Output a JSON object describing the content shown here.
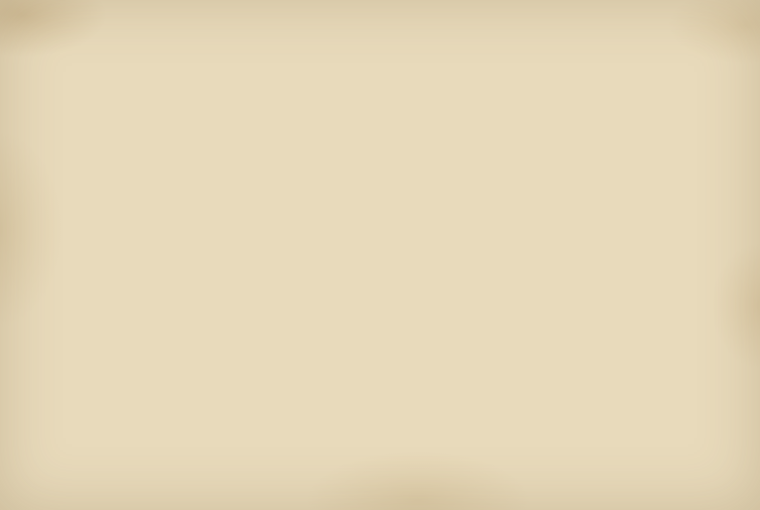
{
  "map": {
    "compass": {
      "south": "南",
      "north": "北",
      "west": "西"
    },
    "palette": {
      "paper": "#e8dabb",
      "paper_light": "#efe3c6",
      "water": "#adc2cc",
      "water_deep": "#93abba",
      "water_light": "#c9d6db",
      "bank_dark": "#3f3426",
      "bank_mid": "#8a7457",
      "bank_block": "#55462f",
      "ink": "#433827",
      "ink_dark": "#171310",
      "red": "#bf3a28",
      "salmon": "#df9166",
      "g1": "#b5c08c",
      "g2": "#a9b77e",
      "p1": "#f0d9cf",
      "p2": "#ecd3c6",
      "cream": "#f0e5c6",
      "blue": "#7495b4",
      "red_bldg": "#b5532f",
      "yellow": "#e6c93f",
      "slip": "#faf4e3",
      "stamp": "#6b6b3a"
    },
    "parcels": [
      {
        "x": 0,
        "y": 178,
        "w": 22,
        "h": 46,
        "r": -10,
        "f": "p1",
        "t": "嶋屋"
      },
      {
        "x": 36,
        "y": 160,
        "w": 30,
        "h": 62,
        "r": -10,
        "f": "p1",
        "t": "樽屋"
      },
      {
        "x": 70,
        "y": 150,
        "w": 26,
        "h": 50,
        "r": -10,
        "f": "cream",
        "t": ""
      },
      {
        "x": 146,
        "y": 128,
        "w": 34,
        "h": 88,
        "r": -8,
        "f": "p1",
        "t": "美濃屋"
      },
      {
        "x": 183,
        "y": 144,
        "w": 26,
        "h": 54,
        "r": -8,
        "f": "p2",
        "t": "蔵"
      },
      {
        "x": 152,
        "y": 194,
        "w": 62,
        "h": 20,
        "r": -8,
        "f": "g1",
        "t": "平野屋",
        "hz": 1,
        "fs": 5
      },
      {
        "x": 177,
        "y": 122,
        "w": 16,
        "h": 13,
        "r": -8,
        "f": "g2",
        "t": ""
      },
      {
        "x": 262,
        "y": 124,
        "w": 30,
        "h": 72,
        "r": -5,
        "f": "p1",
        "t": "蔵"
      },
      {
        "x": 295,
        "y": 118,
        "w": 24,
        "h": 58,
        "r": -5,
        "f": "cream",
        "t": ""
      },
      {
        "x": 210,
        "y": 94,
        "w": 38,
        "h": 40,
        "r": -4,
        "f": "g1",
        "t": "町会所",
        "fs": 6
      },
      {
        "x": 250,
        "y": 100,
        "w": 44,
        "h": 38,
        "r": -4,
        "f": "cream",
        "t": ""
      },
      {
        "x": 322,
        "y": 96,
        "w": 40,
        "h": 40,
        "r": -3,
        "f": "cream",
        "t": ""
      },
      {
        "x": 380,
        "y": 74,
        "w": 17,
        "h": 17,
        "r": 0,
        "f": "blue",
        "t": ""
      },
      {
        "x": 404,
        "y": 68,
        "w": 38,
        "h": 20,
        "r": 0,
        "f": "g1",
        "t": "大工小屋",
        "hz": 1,
        "fs": 5
      },
      {
        "x": 444,
        "y": 74,
        "w": 22,
        "h": 18,
        "r": 0,
        "f": "g2",
        "t": ""
      },
      {
        "x": 468,
        "y": 72,
        "w": 18,
        "h": 18,
        "r": 2,
        "f": "g1",
        "t": ""
      },
      {
        "x": 488,
        "y": 76,
        "w": 26,
        "h": 22,
        "r": 3,
        "f": "cream",
        "t": ""
      },
      {
        "x": 516,
        "y": 80,
        "w": 30,
        "h": 24,
        "r": 4,
        "f": "cream",
        "t": ""
      },
      {
        "x": 556,
        "y": 86,
        "w": 82,
        "h": 40,
        "r": 6,
        "f": "g1",
        "t": "乙嶋屋",
        "fs": 6
      },
      {
        "x": 642,
        "y": 104,
        "w": 44,
        "h": 30,
        "r": 8,
        "f": "g2",
        "t": ""
      },
      {
        "x": 576,
        "y": 118,
        "w": 132,
        "h": 44,
        "r": 9,
        "f": "cream",
        "t": "御比量所",
        "hz": 1,
        "fs": 8
      },
      {
        "x": 718,
        "y": 172,
        "w": 16,
        "h": 15,
        "r": 10,
        "f": "blue",
        "t": ""
      },
      {
        "x": 739,
        "y": 168,
        "w": 18,
        "h": 16,
        "r": 10,
        "f": "g1",
        "t": ""
      },
      {
        "x": 598,
        "y": 116,
        "w": 24,
        "h": 74,
        "r": 8,
        "f": "g1",
        "t": "米屋"
      },
      {
        "x": 622,
        "y": 128,
        "w": 24,
        "h": 76,
        "r": 8,
        "f": "g2",
        "t": "綿屋"
      },
      {
        "x": 646,
        "y": 144,
        "w": 22,
        "h": 64,
        "r": 9,
        "f": "cream",
        "t": ""
      },
      {
        "x": 668,
        "y": 152,
        "w": 24,
        "h": 64,
        "r": 9,
        "f": "g1",
        "t": "炭屋"
      },
      {
        "x": 700,
        "y": 202,
        "w": 28,
        "h": 38,
        "r": 10,
        "f": "p1",
        "t": "伊勢屋",
        "fs": 5
      },
      {
        "x": 730,
        "y": 206,
        "w": 26,
        "h": 42,
        "r": 10,
        "f": "g1",
        "t": "肴屋"
      },
      {
        "x": 736,
        "y": 248,
        "w": 24,
        "h": 40,
        "r": 11,
        "f": "g2",
        "t": ""
      },
      {
        "x": 0,
        "y": 224,
        "w": 26,
        "h": 54,
        "r": -10,
        "f": "p2",
        "t": "升屋"
      },
      {
        "x": 28,
        "y": 216,
        "w": 34,
        "h": 58,
        "r": -10,
        "f": "p1",
        "t": "槌屋"
      },
      {
        "x": 64,
        "y": 196,
        "w": 28,
        "h": 48,
        "r": -10,
        "f": "cream",
        "t": ""
      },
      {
        "x": 30,
        "y": 252,
        "w": 54,
        "h": 22,
        "r": -9,
        "f": "g1",
        "t": "塩屋",
        "hz": 1
      },
      {
        "x": 86,
        "y": 244,
        "w": 72,
        "h": 24,
        "r": -8,
        "f": "g2",
        "t": "木屋佐兵衛",
        "hz": 1,
        "fs": 5
      },
      {
        "x": 118,
        "y": 286,
        "w": 40,
        "h": 34,
        "r": -8,
        "f": "p1",
        "t": "近江屋",
        "fs": 5
      },
      {
        "x": 160,
        "y": 236,
        "w": 58,
        "h": 22,
        "r": -7,
        "f": "g1",
        "t": "米屋",
        "hz": 1
      },
      {
        "x": 218,
        "y": 228,
        "w": 42,
        "h": 34,
        "r": -6,
        "f": "g1",
        "t": "丸屋",
        "fs": 6
      },
      {
        "x": 300,
        "y": 190,
        "w": 36,
        "h": 28,
        "r": -4,
        "f": "g1",
        "t": "油屋",
        "hz": 1
      },
      {
        "x": 338,
        "y": 214,
        "w": 32,
        "h": 26,
        "r": -4,
        "f": "g2",
        "t": "辻屋",
        "hz": 1
      },
      {
        "x": 346,
        "y": 126,
        "w": 30,
        "h": 80,
        "r": -3,
        "f": "p1",
        "t": "蔵"
      },
      {
        "x": 346,
        "y": 208,
        "w": 28,
        "h": 22,
        "r": -3,
        "f": "g1",
        "t": ""
      },
      {
        "x": 420,
        "y": 94,
        "w": 62,
        "h": 30,
        "r": -2,
        "f": "cream",
        "t": ""
      },
      {
        "x": 476,
        "y": 94,
        "w": 42,
        "h": 92,
        "r": -2,
        "f": "p1",
        "t": "松屋"
      },
      {
        "x": 516,
        "y": 174,
        "w": 58,
        "h": 82,
        "r": 2,
        "f": "g1",
        "t": "山屋惣兵衛",
        "fs": 6
      },
      {
        "x": 576,
        "y": 184,
        "w": 42,
        "h": 60,
        "r": 6,
        "f": "g2",
        "t": "木屋"
      },
      {
        "x": 618,
        "y": 194,
        "w": 46,
        "h": 56,
        "r": 7,
        "f": "g1",
        "t": "桝屋"
      },
      {
        "x": 0,
        "y": 284,
        "w": 30,
        "h": 40,
        "r": -10,
        "f": "p1",
        "t": ""
      },
      {
        "x": 34,
        "y": 298,
        "w": 42,
        "h": 48,
        "r": -10,
        "f": "p2",
        "t": "大黒屋",
        "fs": 5
      },
      {
        "x": 84,
        "y": 290,
        "w": 48,
        "h": 26,
        "r": -9,
        "f": "g1",
        "t": "銭屋",
        "hz": 1
      },
      {
        "x": 130,
        "y": 296,
        "w": 36,
        "h": 52,
        "r": -9,
        "f": "p1",
        "t": "釘屋"
      },
      {
        "x": 168,
        "y": 286,
        "w": 46,
        "h": 24,
        "r": -8,
        "f": "g2",
        "t": "柏屋",
        "hz": 1
      },
      {
        "x": 66,
        "y": 336,
        "w": 46,
        "h": 38,
        "r": -16,
        "f": "g1",
        "t": "御蔵",
        "fs": 6
      },
      {
        "x": 206,
        "y": 296,
        "w": 42,
        "h": 38,
        "r": -7,
        "f": "p2",
        "t": ""
      },
      {
        "x": 252,
        "y": 290,
        "w": 46,
        "h": 38,
        "r": -6,
        "f": "g1",
        "t": "戸嶋屋",
        "fs": 5
      },
      {
        "x": 304,
        "y": 284,
        "w": 40,
        "h": 34,
        "r": -5,
        "f": "g2",
        "t": "御借地",
        "fs": 5
      },
      {
        "x": 382,
        "y": 230,
        "w": 48,
        "h": 28,
        "r": -3,
        "f": "g1",
        "t": "御風呂",
        "hz": 1,
        "fs": 5.5
      },
      {
        "x": 374,
        "y": 268,
        "w": 64,
        "h": 56,
        "r": -2,
        "f": "g1",
        "t": "札場",
        "fs": 10
      },
      {
        "x": 310,
        "y": 332,
        "w": 26,
        "h": 22,
        "r": -2,
        "f": "g1",
        "t": ""
      },
      {
        "x": 455,
        "y": 246,
        "w": 56,
        "h": 52,
        "r": -2,
        "f": "none",
        "t": "御会所",
        "wall": 1,
        "fs": 5
      },
      {
        "x": 530,
        "y": 298,
        "w": 92,
        "h": 48,
        "r": 8,
        "f": "p1",
        "t": "材木置場",
        "hz": 1,
        "fs": 6
      },
      {
        "x": 614,
        "y": 328,
        "w": 100,
        "h": 52,
        "r": 10,
        "f": "p2",
        "t": "御材木蔵",
        "hz": 1,
        "fs": 6
      },
      {
        "x": 627,
        "y": 378,
        "w": 86,
        "h": 52,
        "r": 14,
        "f": "cream",
        "t": "",
        "wall2": 1
      },
      {
        "x": 544,
        "y": 308,
        "w": 22,
        "h": 14,
        "r": 8,
        "f": "red",
        "t": ""
      },
      {
        "x": 582,
        "y": 316,
        "w": 22,
        "h": 14,
        "r": 8,
        "f": "red",
        "t": ""
      },
      {
        "x": 640,
        "y": 342,
        "w": 24,
        "h": 15,
        "r": 10,
        "f": "red",
        "t": ""
      },
      {
        "x": 684,
        "y": 356,
        "w": 24,
        "h": 15,
        "r": 10,
        "f": "red",
        "t": ""
      },
      {
        "x": 612,
        "y": 290,
        "w": 11,
        "h": 10,
        "r": 9,
        "f": "yellow",
        "t": ""
      },
      {
        "x": 712,
        "y": 350,
        "w": 15,
        "h": 12,
        "r": 12,
        "f": "g1",
        "t": ""
      },
      {
        "x": 700,
        "y": 368,
        "w": 13,
        "h": 11,
        "r": 12,
        "f": "g2",
        "t": ""
      },
      {
        "x": 640,
        "y": 252,
        "w": 54,
        "h": 38,
        "r": 9,
        "f": "g1",
        "t": ""
      },
      {
        "x": 694,
        "y": 262,
        "w": 42,
        "h": 36,
        "r": 10,
        "f": "g2",
        "t": ""
      },
      {
        "x": 306,
        "y": 336,
        "w": 26,
        "h": 15,
        "r": 0,
        "f": "g1",
        "t": "船番",
        "hz": 1,
        "fs": 4.5
      },
      {
        "x": 334,
        "y": 335,
        "w": 28,
        "h": 15,
        "r": 0,
        "f": "g2",
        "t": ""
      },
      {
        "x": 364,
        "y": 337,
        "w": 20,
        "h": 13,
        "r": 0,
        "f": "g1",
        "t": ""
      },
      {
        "x": 302,
        "y": 414,
        "w": 13,
        "h": 13,
        "r": -4,
        "f": "g1",
        "t": ""
      },
      {
        "x": 374,
        "y": 410,
        "w": 24,
        "h": 20,
        "r": 0,
        "f": "red",
        "t": "",
        "shrine": 1
      },
      {
        "x": 0,
        "y": 448,
        "w": 12,
        "h": 16,
        "r": -12,
        "f": "g1",
        "t": ""
      }
    ],
    "slips": [
      {
        "x": 240,
        "y": 116,
        "w": 19,
        "h": 58,
        "r": -6,
        "t": "書入改",
        "c": "red"
      },
      {
        "x": 212,
        "y": 160,
        "w": 15,
        "h": 38,
        "r": -6,
        "t": "借家分",
        "c": "red"
      },
      {
        "x": 26,
        "y": 204,
        "w": 16,
        "h": 44,
        "r": -10,
        "t": "家主替",
        "c": "red"
      },
      {
        "x": 4,
        "y": 286,
        "w": 20,
        "h": 48,
        "r": -35,
        "t": "三嶋屋",
        "c": "ink"
      },
      {
        "x": 35,
        "y": 342,
        "w": 12,
        "h": 42,
        "r": -8,
        "t": "引直",
        "c": "red"
      },
      {
        "x": 662,
        "y": 316,
        "w": 17,
        "h": 54,
        "r": 10,
        "t": "御蔵屋敷",
        "c": "ink"
      },
      {
        "x": 352,
        "y": 444,
        "w": 21,
        "h": 64,
        "r": 2,
        "t": "川浚自普請所",
        "c": "red",
        "stamp": 1
      },
      {
        "x": 376,
        "y": 448,
        "w": 15,
        "h": 58,
        "r": 1,
        "t": "御除地分",
        "c": "red"
      },
      {
        "x": 392,
        "y": 450,
        "w": 15,
        "h": 53,
        "r": 0,
        "t": "長濱屋平兵衛",
        "c": "ink"
      },
      {
        "x": 408,
        "y": 452,
        "w": 13,
        "h": 49,
        "r": 0,
        "t": "嶋屋卯兵衛",
        "c": "ink"
      },
      {
        "x": 422,
        "y": 451,
        "w": 14,
        "h": 45,
        "r": -1,
        "t": "伊勢講場",
        "c": "red"
      }
    ],
    "street_notes": [
      {
        "x": 330,
        "y": 118,
        "t": "六番丁境"
      },
      {
        "x": 370,
        "y": 190,
        "t": "此所より"
      },
      {
        "x": 385,
        "y": 193,
        "t": "拾六番町"
      },
      {
        "x": 400,
        "y": 196,
        "t": "屋敷拾三軒"
      },
      {
        "x": 415,
        "y": 199,
        "t": "家数十六軒"
      },
      {
        "x": 548,
        "y": 210,
        "t": "此間六拾間"
      },
      {
        "x": 566,
        "y": 214,
        "t": "七番組"
      },
      {
        "x": 584,
        "y": 218,
        "t": "往還通"
      }
    ],
    "ground_notes": [
      {
        "x": 258,
        "y": 84,
        "t": "浜通",
        "r": -8,
        "fs": 5
      },
      {
        "x": 508,
        "y": 92,
        "t": "川端通",
        "r": 6,
        "fs": 5
      },
      {
        "x": 380,
        "y": 24,
        "t": "宮前",
        "r": 0,
        "fs": 5
      },
      {
        "x": 140,
        "y": 382,
        "t": "川除御普請所",
        "r": -18,
        "fs": 4.5
      },
      {
        "x": 268,
        "y": 440,
        "t": "舟渡場",
        "r": 178,
        "fs": 6
      },
      {
        "x": 420,
        "y": 442,
        "t": "宮嶋渡場",
        "r": 178,
        "fs": 6
      },
      {
        "x": 485,
        "y": 312,
        "t": "御旅所",
        "r": 0,
        "fs": 5,
        "vert": 1
      },
      {
        "x": 360,
        "y": 420,
        "t": "御宮",
        "r": 0,
        "fs": 4.5
      }
    ],
    "ticks": {
      "top": [
        [
          78,
          88
        ],
        [
          222,
          57
        ],
        [
          380,
          40
        ],
        [
          530,
          52
        ],
        [
          688,
          85
        ]
      ],
      "bottom": [
        [
          735,
          436
        ]
      ]
    }
  }
}
